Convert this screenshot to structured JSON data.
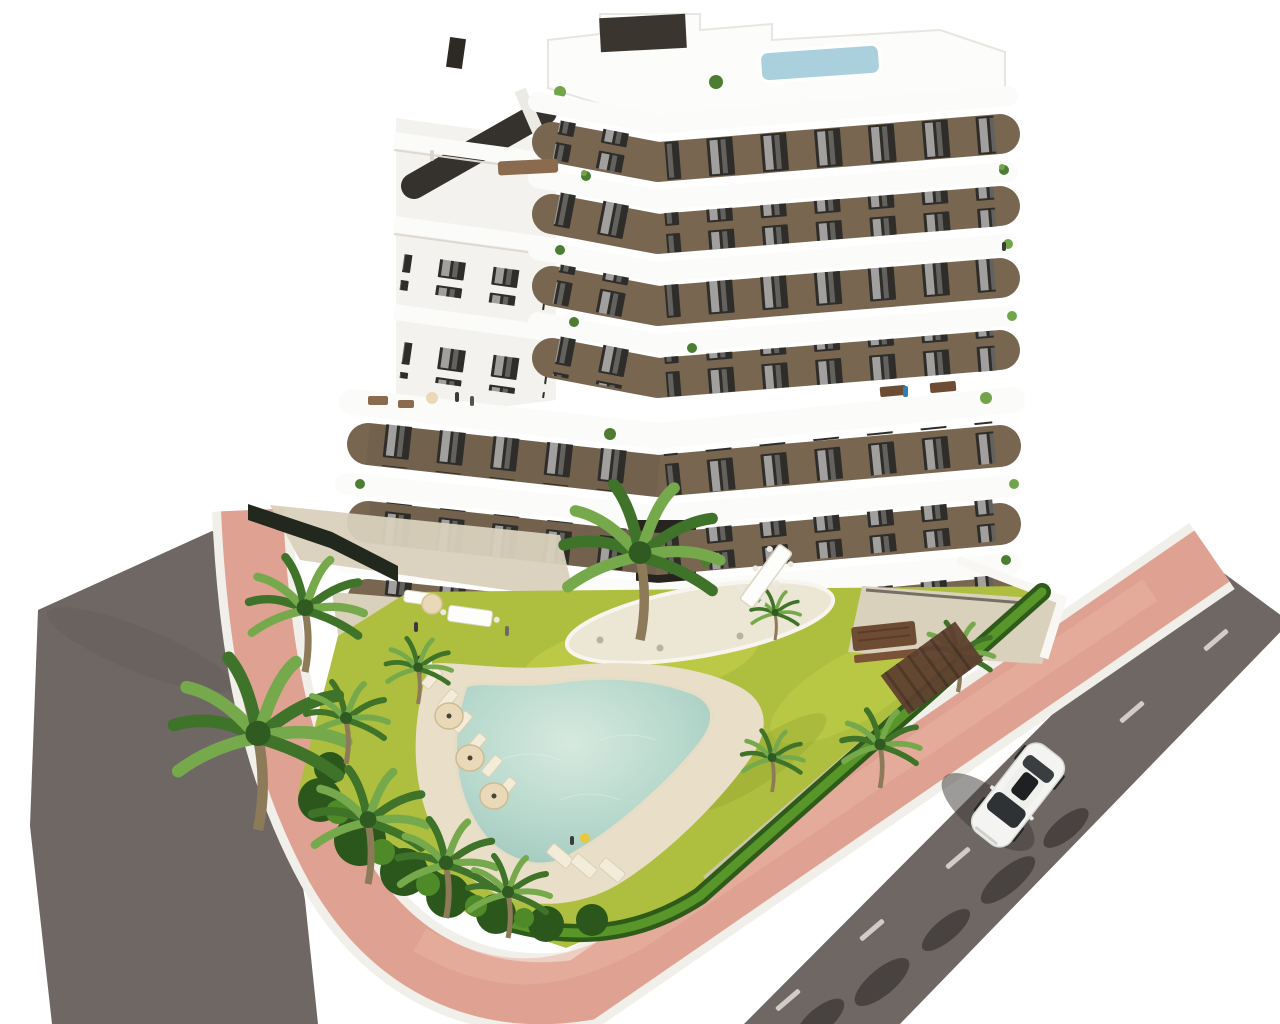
{
  "scene": {
    "type": "aerial architectural render",
    "description": "Bird's-eye 3D render of a modern 7-storey chevron-shaped apartment building with white curved balcony bands and brown facade, rooftop plunge pool, communal garden with free-form swimming pool, sun loungers with cream umbrellas, palm trees, bright hedges, a terracotta-pink perimeter walkway with white curbs, grey asphalt roads on two sides and a single white car driving on the right road",
    "background_color": "#ffffff",
    "canvas": {
      "width": 1280,
      "height": 1024
    }
  },
  "palette": {
    "background": "#ffffff",
    "road": "#6f6764",
    "roadShadow": "#3f3b38",
    "walkway": "#dfa292",
    "walkwayLight": "#e8b2a2",
    "curb": "#f1efe9",
    "grass": "#aebe3f",
    "grassLight": "#c9d44e",
    "hedgeDark": "#2e5a1a",
    "hedgeLight": "#5d9c2c",
    "palmDark": "#3f7329",
    "palmLight": "#76a94b",
    "trunk": "#8d7a58",
    "poolWater": "#b7d8cc",
    "poolWaterLight": "#d6e9df",
    "poolDeck": "#e9dfc9",
    "paving": "#d9d1bc",
    "pavingLight": "#ece6d4",
    "facade": "#786650",
    "facadeShadow": "#5f5040",
    "window": "#2f2d2a",
    "band": "#fbfbfa",
    "bandShadow": "#ddd9d2",
    "roofPool": "#a9d0dc",
    "stairGlass": "#35322d",
    "fence": "#23281e",
    "gravel": "#cfc8b8",
    "wood": "#6e4c34",
    "pergola": "#5f4130",
    "umbrella": "#ead9b8",
    "car": "#f4f4f2",
    "carGlass": "#2e3234"
  },
  "building": {
    "storeys_visible": 7,
    "shape": "chevron / zig-zag wings meeting at a central vertex",
    "facade": "brown render with dark-framed windows and white curtains",
    "balconies": "continuous white rounded slab bands on every floor",
    "rooftop": {
      "plunge_pool": true,
      "stair_tower": true,
      "terrace_furniture": true
    }
  },
  "site": {
    "swimming_pool": {
      "shape": "free-form boomerang",
      "water": "pale turquoise",
      "deck": "sand beige"
    },
    "garden": {
      "lawn": "yellow-green grass",
      "island_planting_bed": true
    },
    "palm_trees_count": 12,
    "sun_loungers_count": 9,
    "sun_umbrellas_count": 3,
    "hedge": "bright clipped hedge along walkway",
    "walkway": {
      "color_name": "terracotta pink",
      "curbs": "white"
    },
    "roads": {
      "left": "grey asphalt",
      "right": "grey asphalt with dashed white centre line"
    },
    "perimeter_fence": "dark slatted fence at upper-left entrance"
  },
  "vehicles": {
    "car": {
      "color": "white",
      "location": "right road",
      "heading": "diagonal, towards lower-left"
    }
  },
  "road_markings": {
    "dash_color": "#dcd9d4",
    "dash_count": 5
  }
}
